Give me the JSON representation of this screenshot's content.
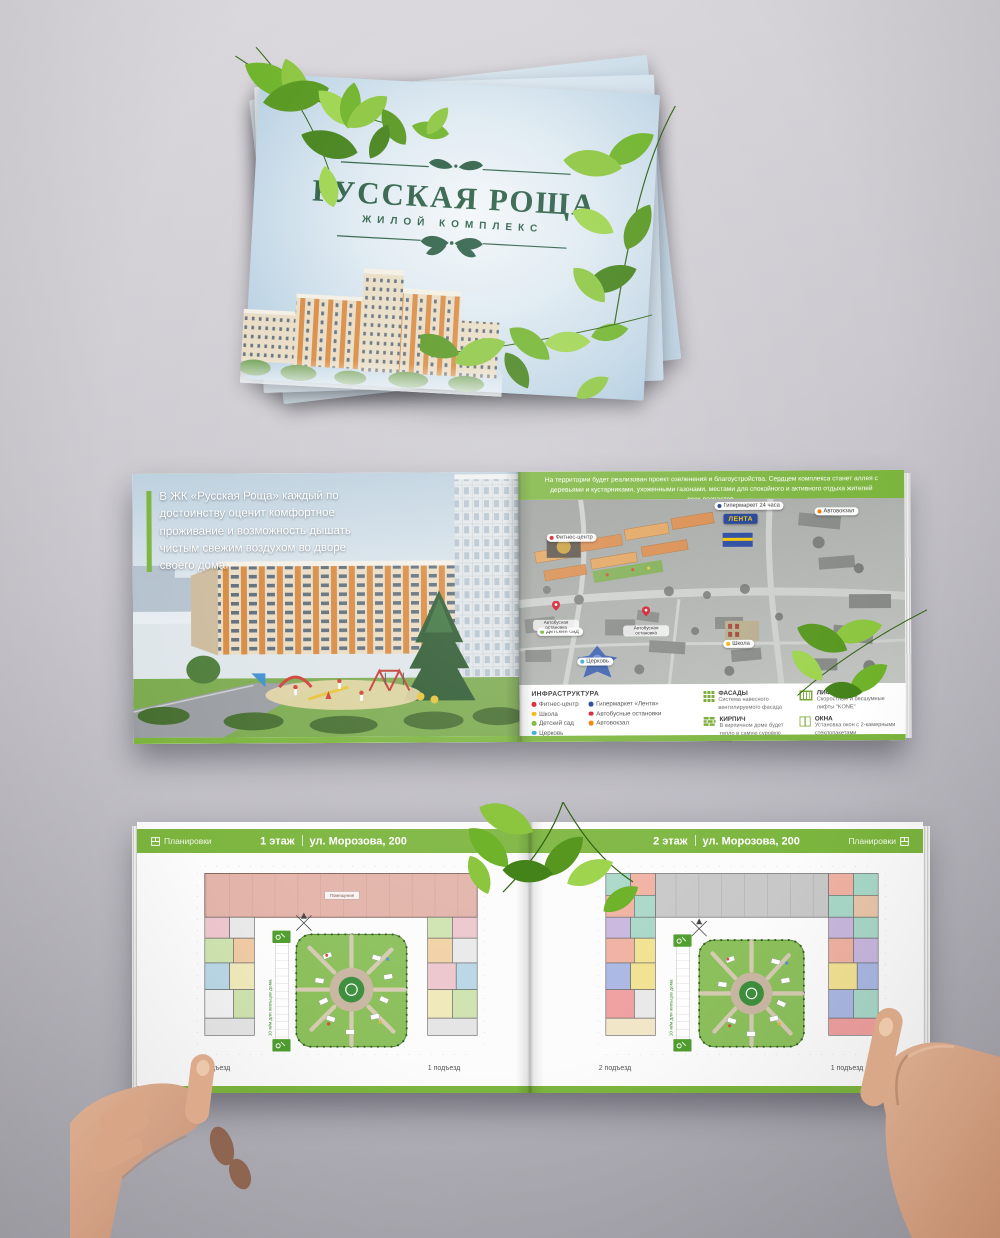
{
  "brand": {
    "accent_green": "#7cb53e",
    "logo_green": "#2d5f46"
  },
  "cover": {
    "title": "РУССКАЯ РОЩА",
    "subtitle": "ЖИЛОЙ КОМПЛЕКС"
  },
  "spread1": {
    "left": {
      "caption": "В ЖК «Русская Роща» каждый по достоинству оценит комфортное проживание и возможность дышать чистым свежим воздухом во дворе своего дома."
    },
    "right": {
      "header": "На территории будет реализован проект озеленения и благоустройства. Сердцем комплекса станет аллея с деревьями и кустарниками, ухоженными газонами, местами для спокойного и активного отдыха жителей всех возрастов.",
      "map": {
        "lenta": "ЛЕНТА",
        "labels": [
          {
            "text": "Фитнес-центр",
            "color": "#d7182a"
          },
          {
            "text": "Гипермаркет 24 часа",
            "color": "#1d3f94"
          },
          {
            "text": "Автовокзал",
            "color": "#f07d00"
          },
          {
            "text": "Детский сад",
            "color": "#76b82a"
          },
          {
            "text": "Церковь",
            "color": "#3aa5dc"
          },
          {
            "text": "Школа",
            "color": "#f0b500"
          },
          {
            "text": "Автобусная остановка",
            "color": "#d7182a"
          }
        ]
      },
      "legend": {
        "title": "ИНФРАСТРУКТУРА",
        "col1": [
          {
            "text": "Фитнес-центр",
            "color": "#d7182a"
          },
          {
            "text": "Школа",
            "color": "#f0b500"
          },
          {
            "text": "Детский сад",
            "color": "#76b82a"
          },
          {
            "text": "Церковь",
            "color": "#3aa5dc"
          }
        ],
        "col2": [
          {
            "text": "Гипермаркет «Лента»",
            "color": "#1d3f94"
          },
          {
            "text": "Автобусные остановки",
            "color": "#d7182a"
          },
          {
            "text": "Автовокзал",
            "color": "#f07d00"
          }
        ],
        "features": [
          {
            "title": "ФАСАДЫ",
            "text": "Система навесного вентилируемого фасада"
          },
          {
            "title": "КИРПИЧ",
            "text": "В кирпичном доме будет тепло в самую суровую зиму"
          },
          {
            "title": "ЛИФТЫ",
            "text": "Скоростные и бесшумные лифты \"KONE\""
          },
          {
            "title": "ОКНА",
            "text": "Установка окон с 2-камерными стеклопакетами"
          }
        ]
      }
    }
  },
  "spread2": {
    "left": {
      "badge": "Планировки",
      "floor": "1 этаж",
      "address": "ул. Морозова, 200",
      "top_wing_label": "Помещения",
      "parking_note": "10 м/м для жильцов дома",
      "entrance_left": "2 подъезд",
      "entrance_right": "1 подъезд"
    },
    "right": {
      "badge": "Планировки",
      "floor": "2 этаж",
      "address": "ул. Морозова, 200",
      "parking_note": "10 м/м для жильцов дома",
      "entrance_left": "2 подъезд",
      "entrance_right": "1 подъезд"
    }
  }
}
